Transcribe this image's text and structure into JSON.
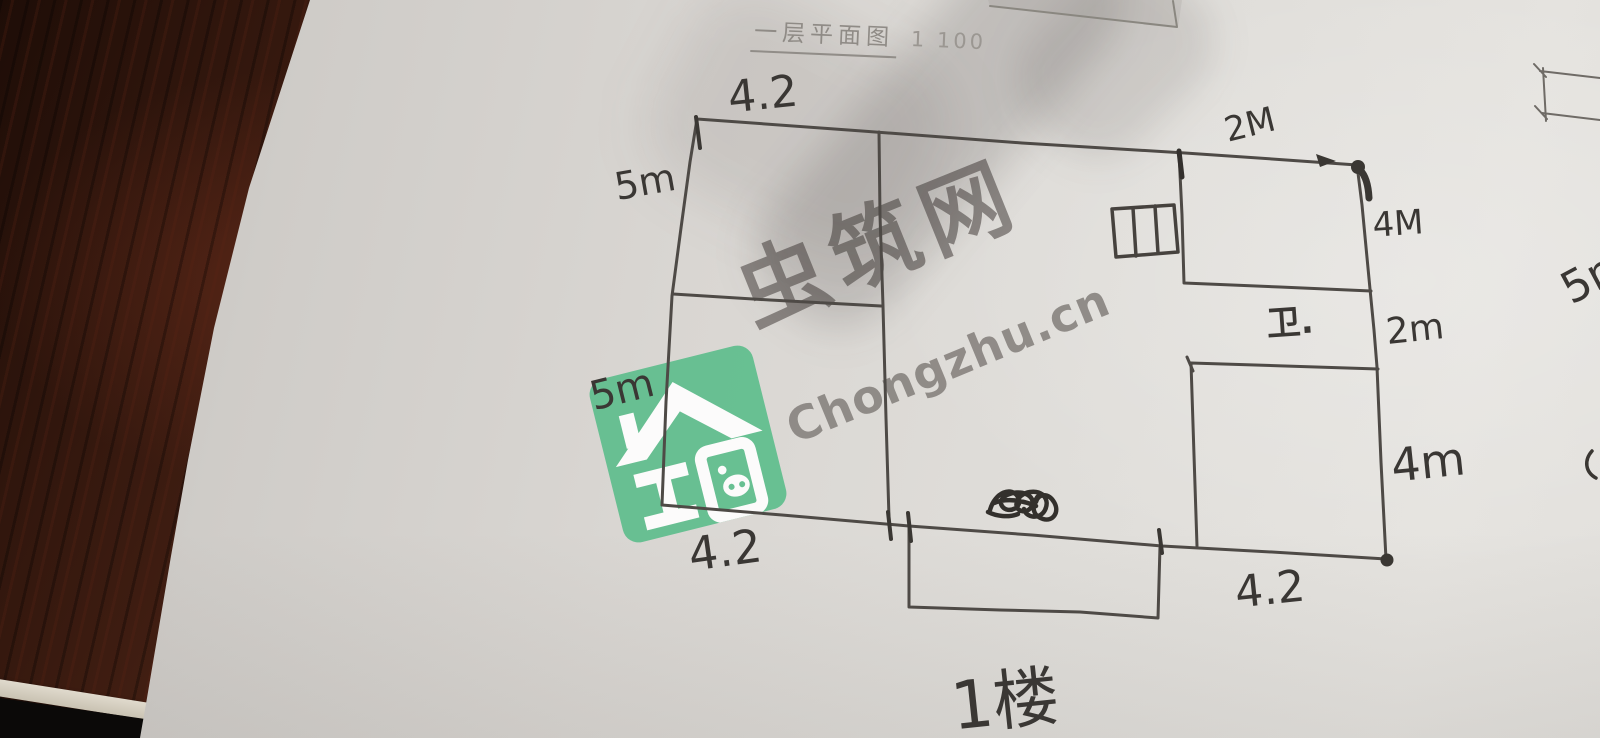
{
  "title": {
    "text": "一层平面图",
    "scale": "1 100"
  },
  "dims": {
    "top_left": "4.2",
    "left_upper": "5m",
    "left_lower": "5m",
    "top_right": "2M",
    "right_upper": "4M",
    "right_middle": "2m",
    "right_lower": "4m",
    "bottom_left": "4.2",
    "bottom_right": "4.2",
    "right_edge_partial": "5m"
  },
  "labels": {
    "bathroom": "卫.",
    "floor": "1楼"
  },
  "watermark": {
    "name": "虫筑网",
    "url": "Chongzhu.cn",
    "brand_color": "#5fbe8d"
  },
  "colors": {
    "ink": "#4e4a46",
    "dark_ink": "#3a3733",
    "paper": "#d9d6d2",
    "wood": "#472114"
  }
}
